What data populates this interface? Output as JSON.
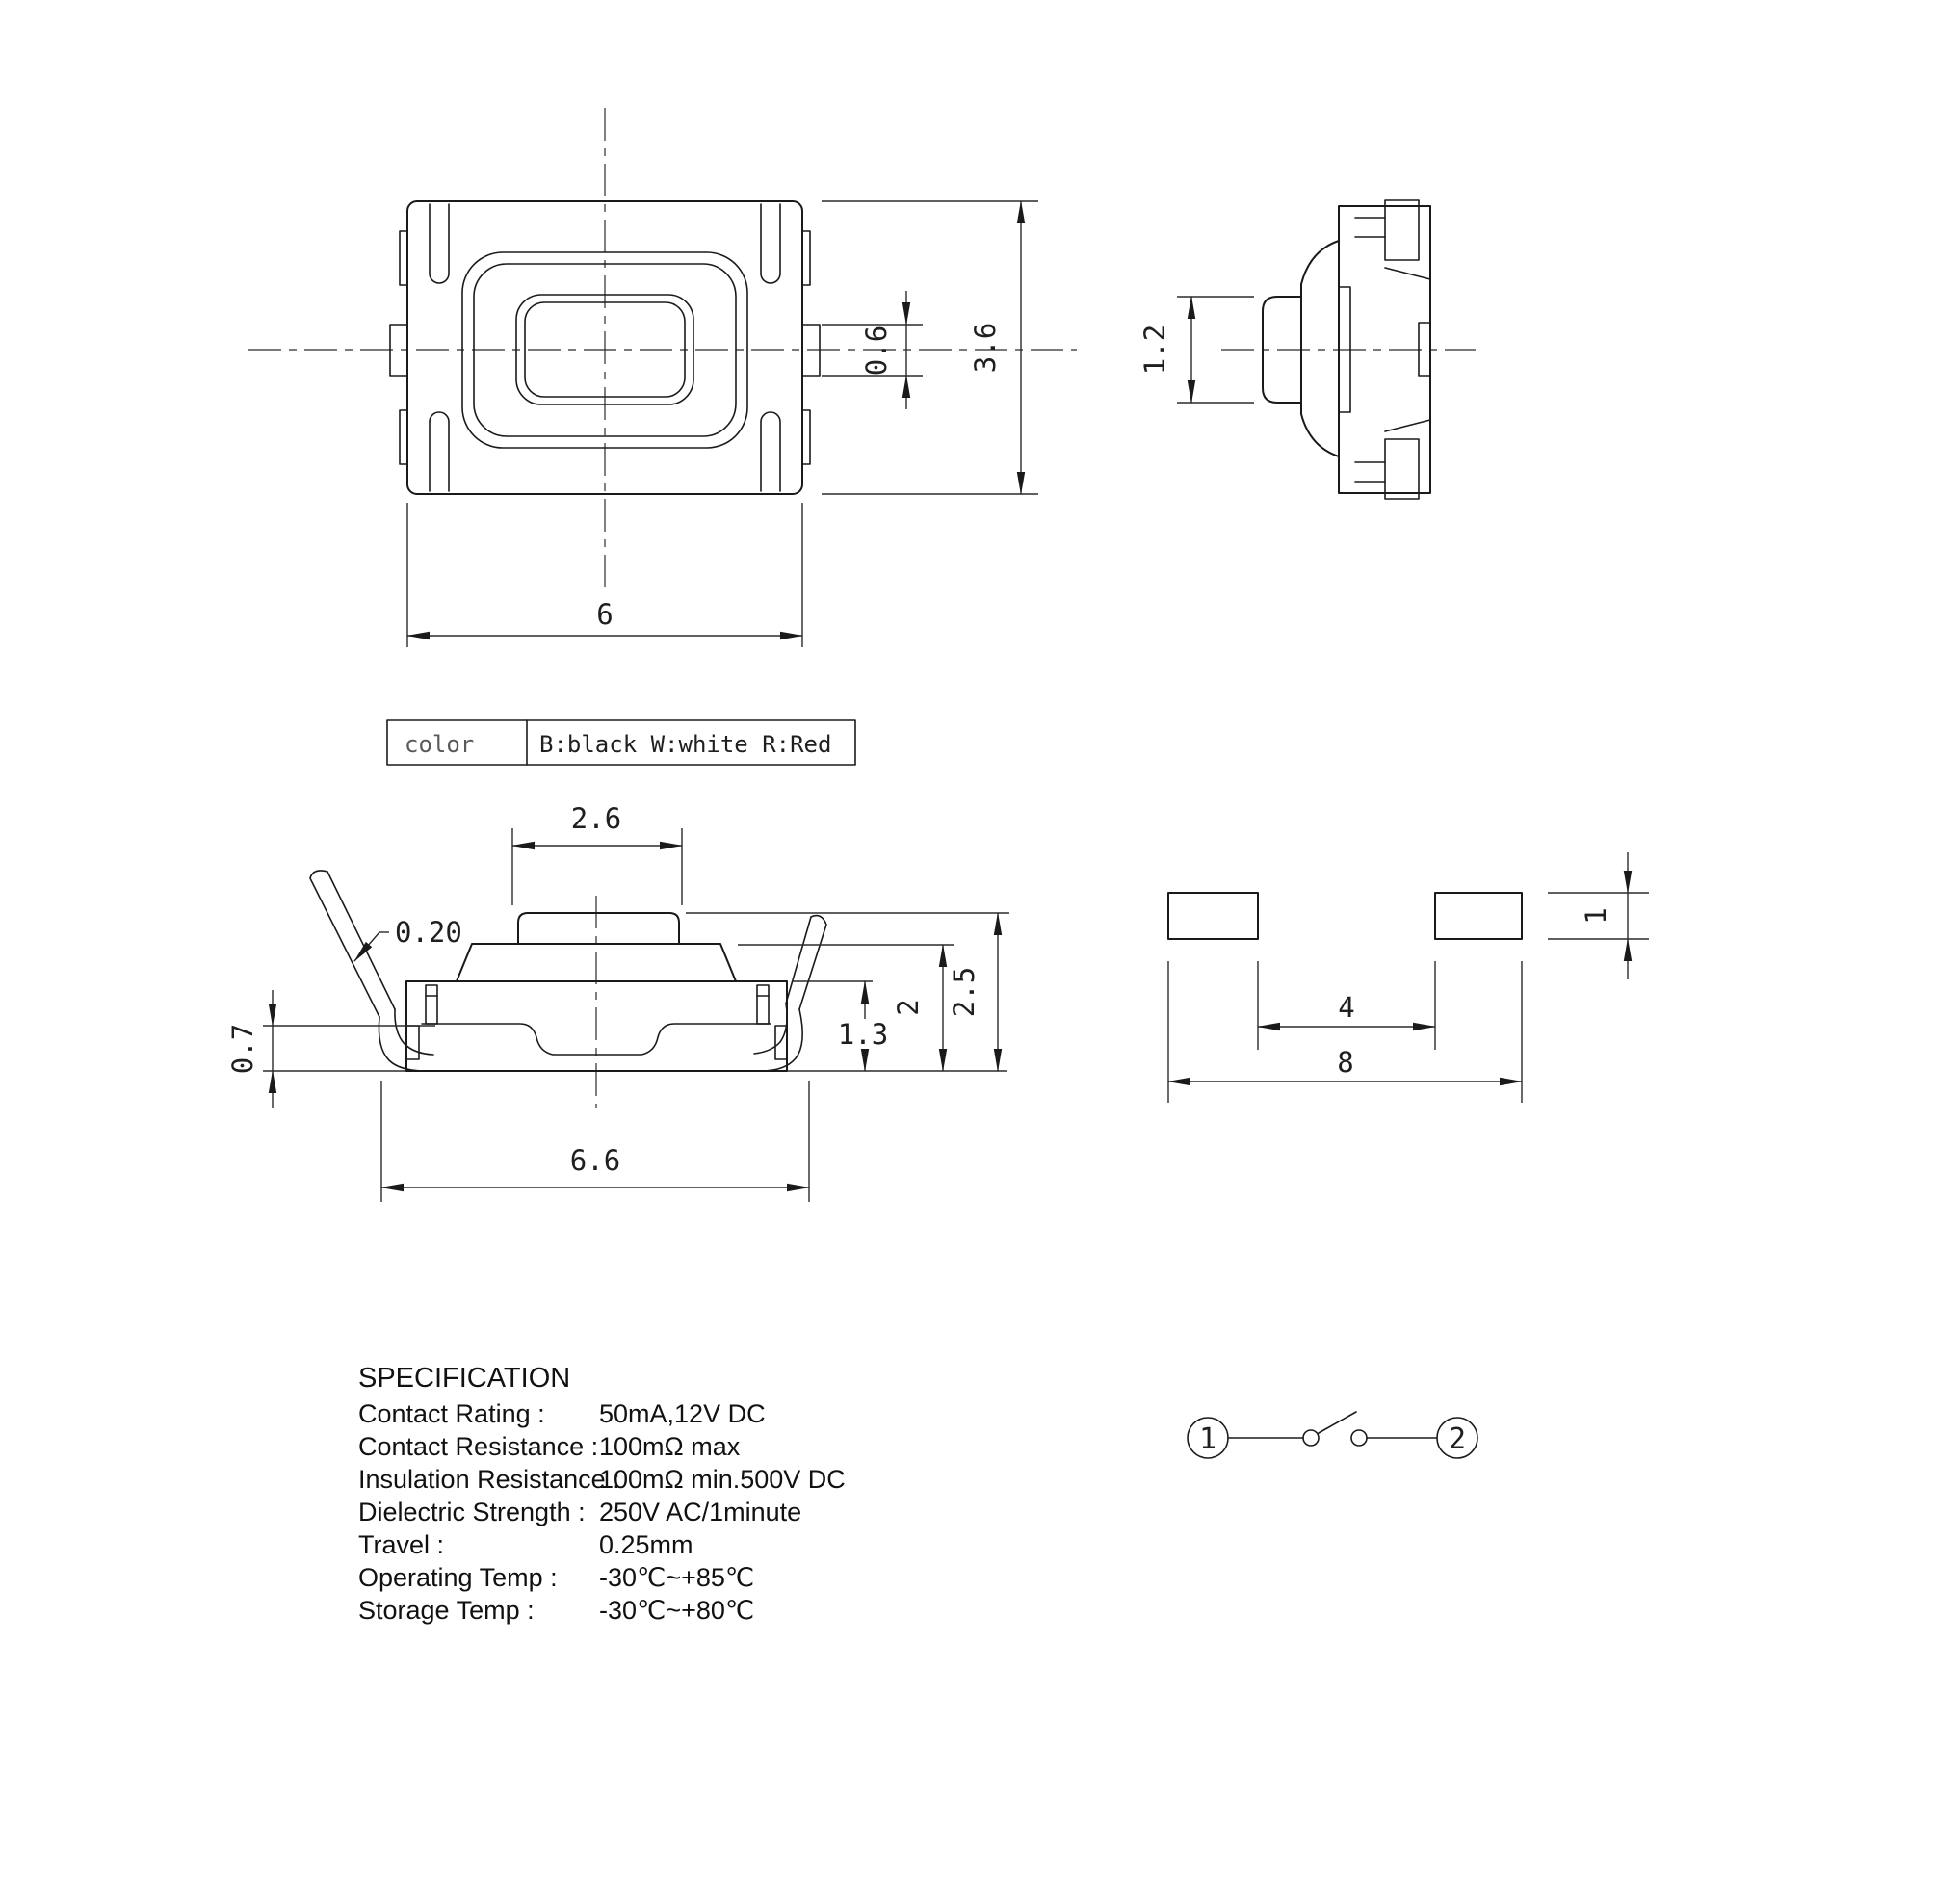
{
  "dims": {
    "top_width": "6",
    "tab_height": "0.6",
    "top_height": "3.6",
    "side_button_width": "1.2",
    "button_width": "2.6",
    "lead_thickness": "0.20",
    "foot_height": "0.7",
    "lead_span": "6.6",
    "body_height": "1.3",
    "cap_height": "2",
    "total_height": "2.5",
    "pad_gap": "4",
    "pad_span": "8",
    "pad_height": "1"
  },
  "color_table": {
    "label": "color",
    "value": "B:black W:white R:Red"
  },
  "spec": {
    "title": "SPECIFICATION",
    "rows": [
      {
        "label": "Contact  Rating :",
        "value": "50mA,12V DC"
      },
      {
        "label": "Contact  Resistance :",
        "value": "100mΩ max"
      },
      {
        "label": "Insulation Resistance :",
        "value": "100mΩ min.500V DC"
      },
      {
        "label": "Dielectric  Strength :",
        "value": "250V AC/1minute"
      },
      {
        "label": "Travel :",
        "value": "0.25mm"
      },
      {
        "label": "Operating Temp :",
        "value": "-30℃~+85℃"
      },
      {
        "label": "Storage Temp :",
        "value": "-30℃~+80℃"
      }
    ]
  },
  "circuit": {
    "t1": "1",
    "t2": "2"
  }
}
